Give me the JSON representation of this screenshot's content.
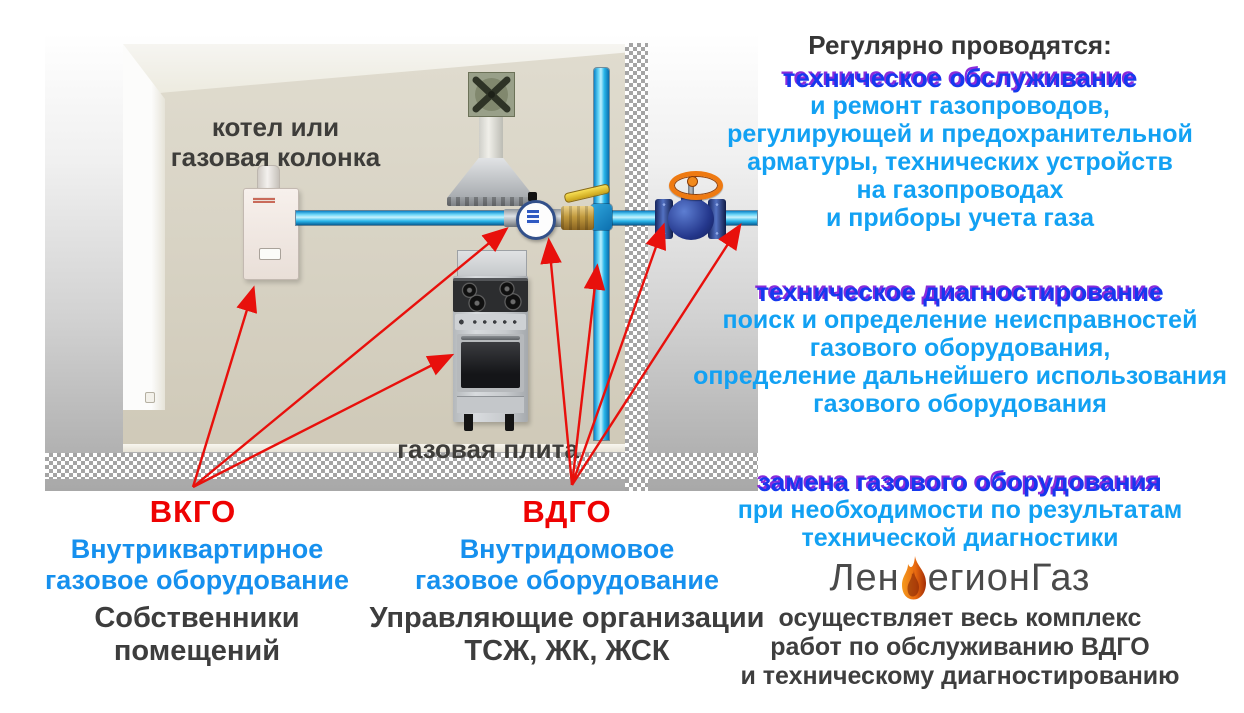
{
  "colors": {
    "accent_red": "#ee0202",
    "arrow_red": "#e8100c",
    "azure_text": "#12a1f3",
    "heading_blue": "#1638ee",
    "heading_shadow_purple": "#7a0ed6",
    "legend_blue": "#1690ee",
    "pipe_cyan": "#29b6ea",
    "valve_blue": "#24378c",
    "wheel_orange": "#ee7a12",
    "flame_orange": "#f08a1c",
    "dark_text": "#3d3d3d"
  },
  "scene": {
    "boiler_label": [
      "котел или",
      "газовая колонка"
    ],
    "stove_label": "газовая плита",
    "equipment": [
      "boiler",
      "extractor-hood",
      "vent-fan",
      "gas-meter",
      "ball-valve",
      "gas-stove",
      "riser-pipe",
      "gate-valve"
    ]
  },
  "legend": {
    "vkgo": {
      "abbr": "ВКГО",
      "title": [
        "Внутриквартирное",
        "газовое оборудование"
      ],
      "owner": [
        "Собственники",
        "помещений"
      ]
    },
    "vdgo": {
      "abbr": "ВДГО",
      "title": [
        "Внутридомовое",
        "газовое оборудование"
      ],
      "owner": [
        "Управляющие организации",
        "ТСЖ, ЖК, ЖСК"
      ]
    }
  },
  "right_panel": {
    "heading": "Регулярно проводятся:",
    "sections": [
      {
        "title": "техническое обслуживание",
        "lines": [
          "и ремонт газопроводов,",
          "регулирующей и предохранительной",
          "арматуры, технических устройств",
          "на газопроводах",
          "и приборы учета газа"
        ]
      },
      {
        "title": "техническое диагностирование",
        "lines": [
          "поиск и определение неисправностей",
          "газового оборудования,",
          "определение дальнейшего использования",
          "газового оборудования"
        ]
      },
      {
        "title": "замена газового оборудования",
        "lines": [
          "при необходимости по результатам",
          "технической диагностики"
        ]
      }
    ],
    "logo": {
      "prefix": "Лен",
      "suffix": "егионГаз"
    },
    "footer": [
      "осуществляет весь комплекс",
      "работ по обслуживанию ВДГО",
      "и техническому диагностированию"
    ]
  }
}
